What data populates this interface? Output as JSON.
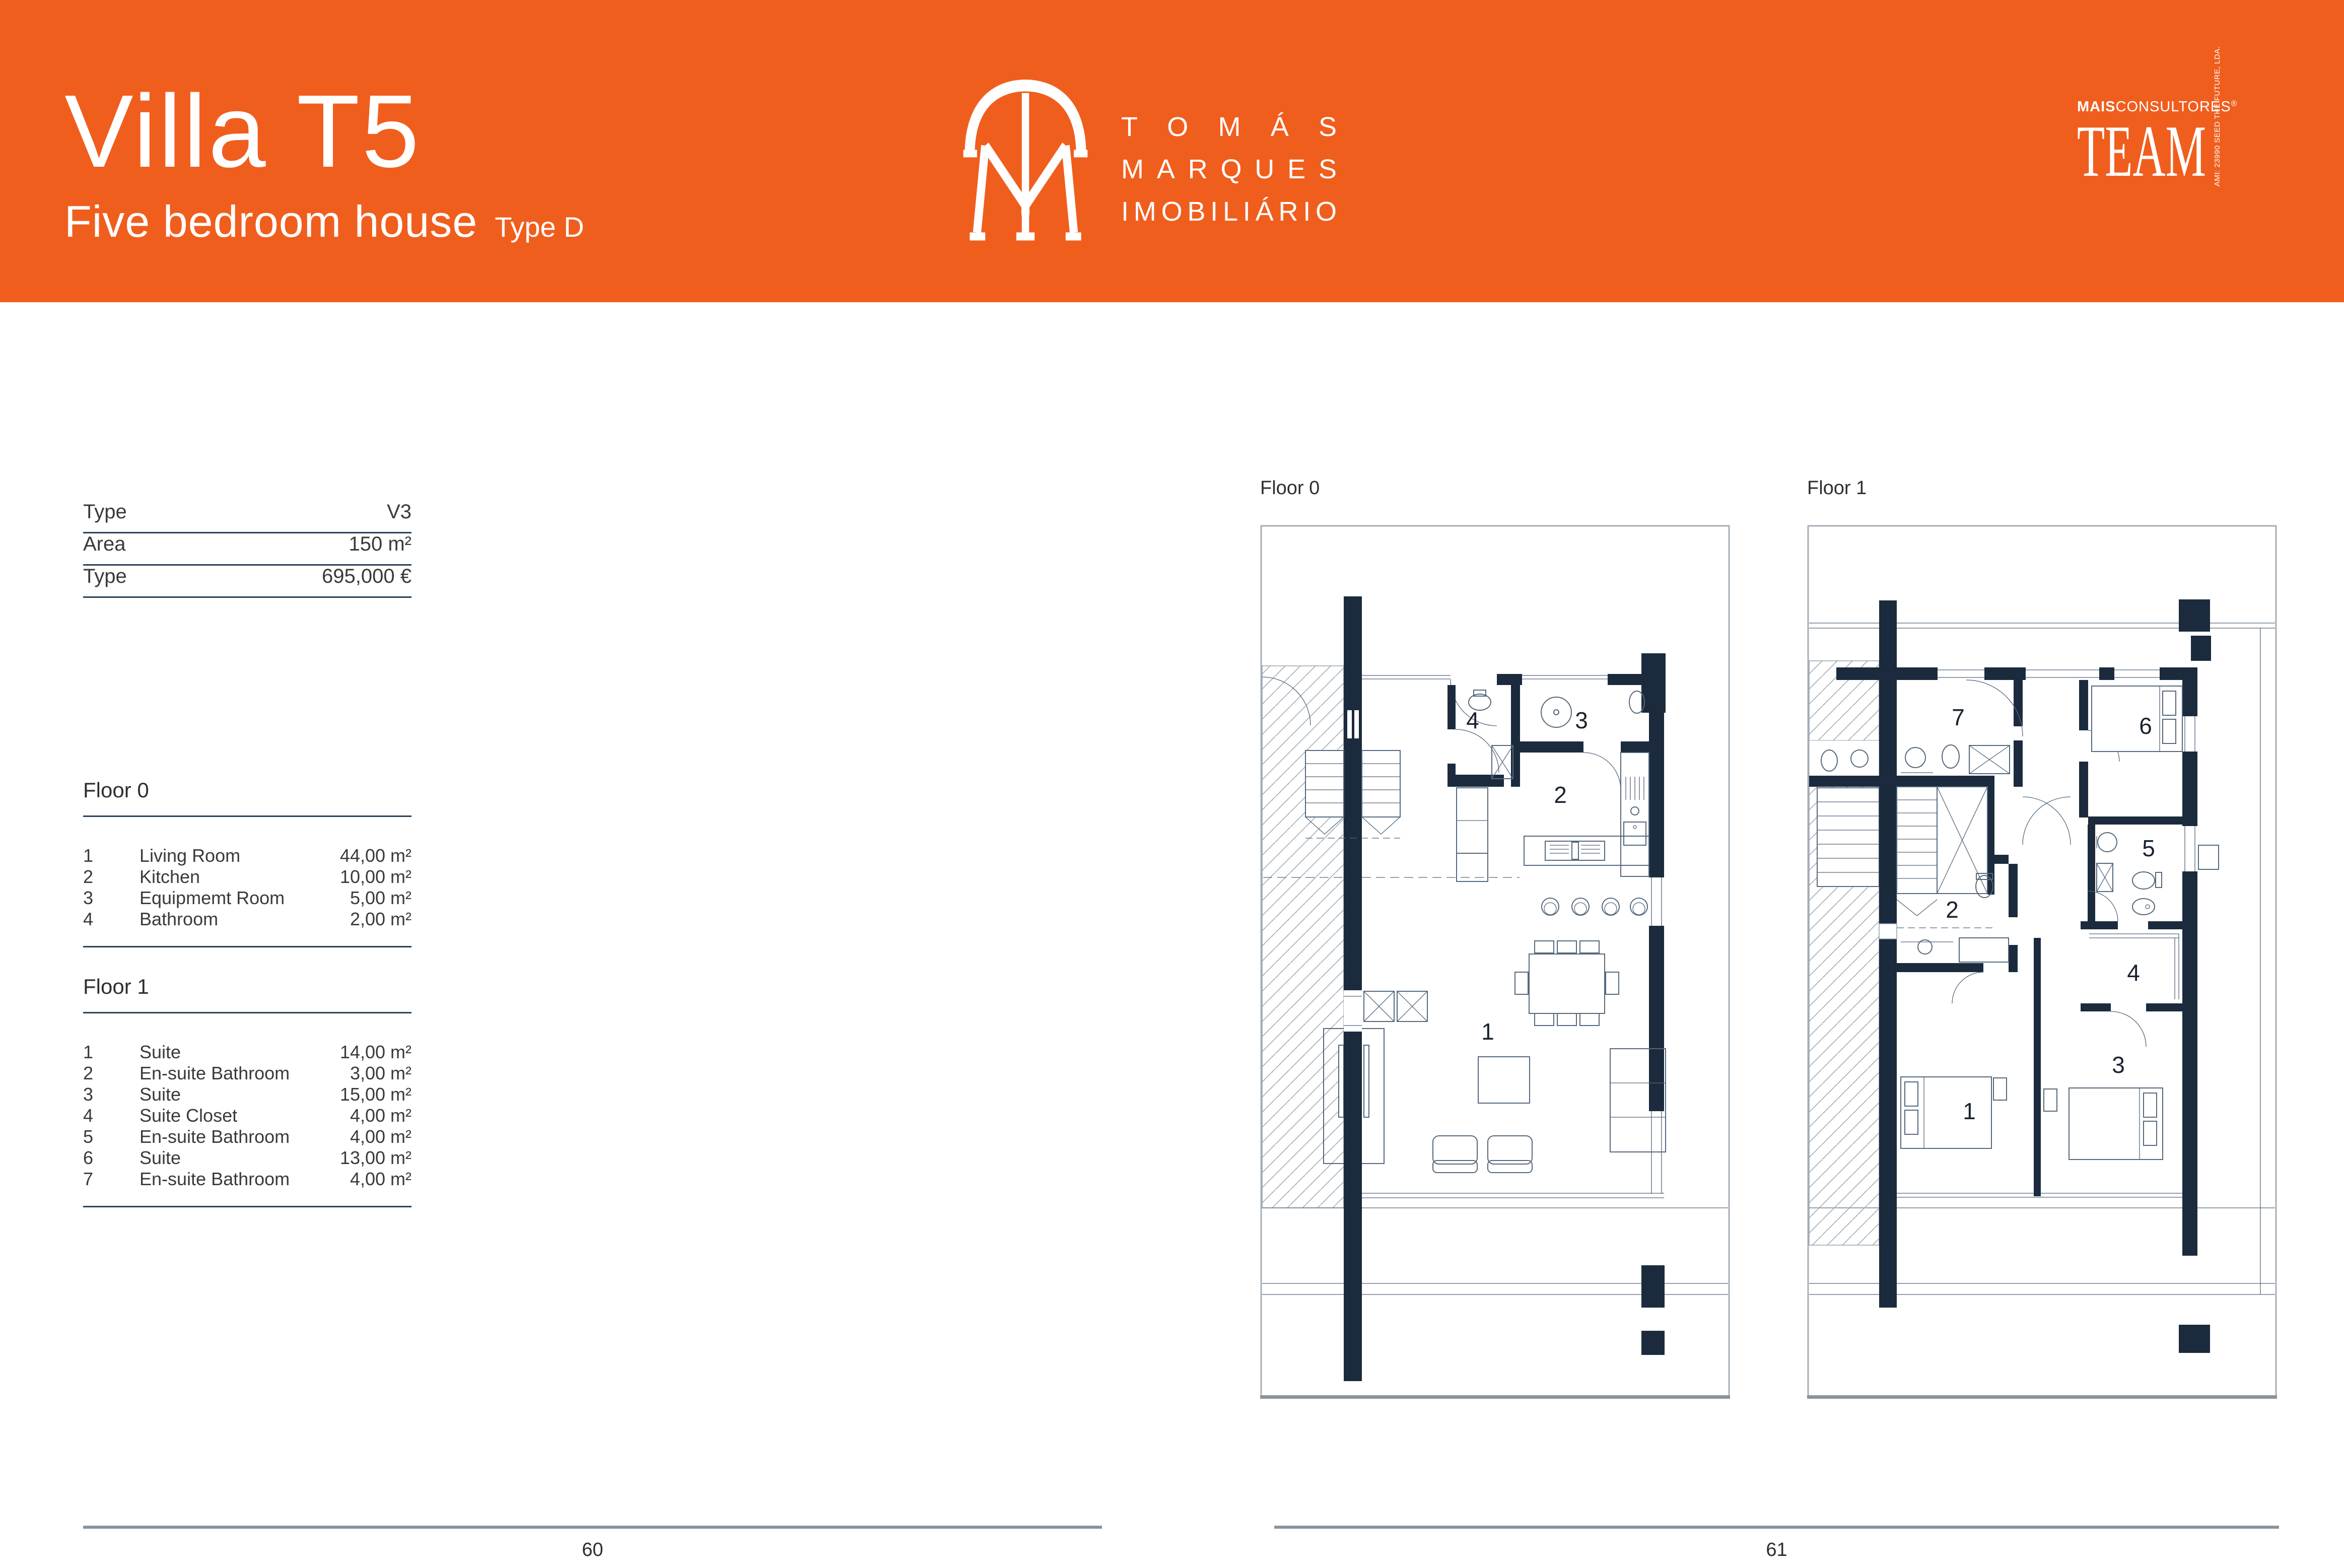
{
  "colors": {
    "orange": "#F05E1E",
    "navy_walls": "#1B2B3D",
    "plan_line": "#54687C",
    "hatch": "#97A4B0",
    "table_rule": "#2C4257",
    "footer_rule": "#8A939B"
  },
  "header": {
    "title": "Villa T5",
    "subtitle": "Five bedroom house",
    "type_note": "Type D",
    "brand_lines": [
      "TOMÁS",
      "MARQUES",
      "IMOBILIÁRIO"
    ],
    "team": {
      "prefix_bold": "MAIS",
      "prefix_light": "CONSULTORES",
      "registered": "®",
      "wordmark": "TEAM",
      "vertical_note": "AMI: 23990   SEED THE FUTURE, LDA."
    }
  },
  "specs": {
    "rows": [
      {
        "label": "Type",
        "value": "V3"
      },
      {
        "label": "Area",
        "value": "150 m²"
      },
      {
        "label": "Type",
        "value": "695,000 €"
      }
    ]
  },
  "legends": [
    {
      "title": "Floor 0",
      "rows": [
        {
          "n": "1",
          "name": "Living Room",
          "area": "44,00 m²"
        },
        {
          "n": "2",
          "name": "Kitchen",
          "area": "10,00 m²"
        },
        {
          "n": "3",
          "name": "Equipmemt Room",
          "area": "5,00 m²"
        },
        {
          "n": "4",
          "name": "Bathroom",
          "area": "2,00 m²"
        }
      ]
    },
    {
      "title": "Floor 1",
      "rows": [
        {
          "n": "1",
          "name": "Suite",
          "area": "14,00 m²"
        },
        {
          "n": "2",
          "name": "En-suite Bathroom",
          "area": "3,00 m²"
        },
        {
          "n": "3",
          "name": "Suite",
          "area": "15,00 m²"
        },
        {
          "n": "4",
          "name": "Suite Closet",
          "area": "4,00 m²"
        },
        {
          "n": "5",
          "name": "En-suite Bathroom",
          "area": "4,00 m²"
        },
        {
          "n": "6",
          "name": "Suite",
          "area": "13,00 m²"
        },
        {
          "n": "7",
          "name": "En-suite Bathroom",
          "area": "4,00 m²"
        }
      ]
    }
  ],
  "plans": {
    "floor0": {
      "label": "Floor 0",
      "rooms": [
        "1",
        "2",
        "3",
        "4"
      ]
    },
    "floor1": {
      "label": "Floor 1",
      "rooms": [
        "1",
        "2",
        "3",
        "4",
        "5",
        "6",
        "7"
      ]
    }
  },
  "footer": {
    "left_page": "60",
    "right_page": "61"
  }
}
